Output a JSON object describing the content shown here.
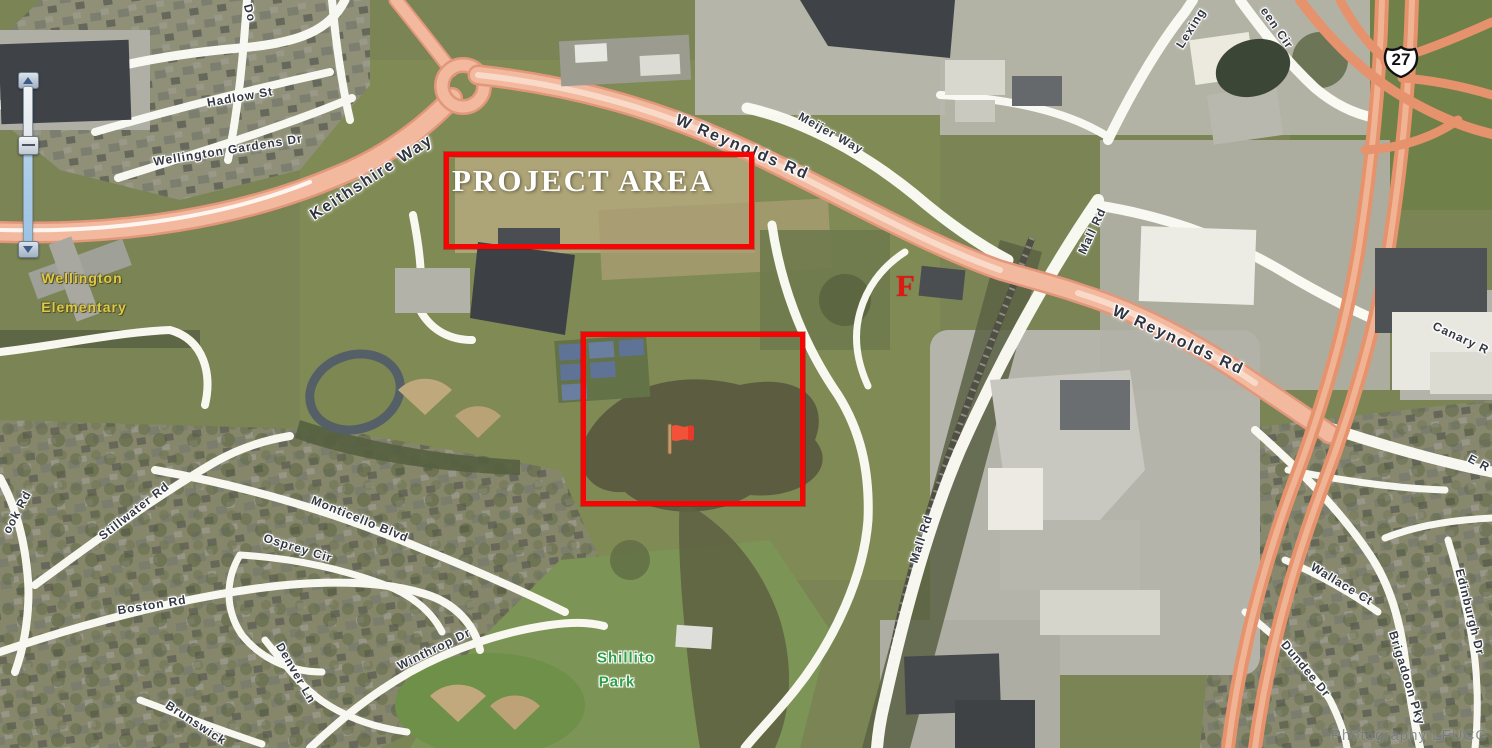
{
  "map": {
    "annotations": {
      "project_area_label": "PROJECT AREA",
      "f_marker": "F",
      "highway_shield": "27",
      "watermark": "Photography LFUCG"
    },
    "labels": [
      {
        "text": "Do",
        "x": 250,
        "y": 13,
        "rot": 75,
        "kind": "road",
        "name": "road-label-do-partial"
      },
      {
        "text": "Hadlow St",
        "x": 240,
        "y": 97,
        "rot": -10,
        "kind": "road",
        "name": "road-label-hadlow-st"
      },
      {
        "text": "Wellington Gardens Dr",
        "x": 228,
        "y": 150,
        "rot": -9,
        "kind": "road",
        "name": "road-label-wellington-gardens-dr"
      },
      {
        "text": "Keithshire Way",
        "x": 372,
        "y": 178,
        "rot": -33,
        "kind": "road-big",
        "name": "road-label-keithshire-way"
      },
      {
        "text": "W Reynolds Rd",
        "x": 742,
        "y": 148,
        "rot": 23,
        "kind": "road-big",
        "name": "road-label-w-reynolds-rd-west"
      },
      {
        "text": "Meijer Way",
        "x": 831,
        "y": 133,
        "rot": 29,
        "kind": "road",
        "name": "road-label-meijer-way"
      },
      {
        "text": "Lexing",
        "x": 1191,
        "y": 28,
        "rot": -58,
        "kind": "road",
        "name": "road-label-lexington-green-cir-1"
      },
      {
        "text": "een Cir",
        "x": 1277,
        "y": 28,
        "rot": 55,
        "kind": "road",
        "name": "road-label-lexington-green-cir-2"
      },
      {
        "text": "Mall Rd",
        "x": 1092,
        "y": 231,
        "rot": -65,
        "kind": "road",
        "name": "road-label-mall-rd-north"
      },
      {
        "text": "W Reynolds Rd",
        "x": 1178,
        "y": 341,
        "rot": 25,
        "kind": "road-big",
        "name": "road-label-w-reynolds-rd-east"
      },
      {
        "text": "Canary R",
        "x": 1461,
        "y": 338,
        "rot": 25,
        "kind": "road",
        "name": "road-label-canary-rd"
      },
      {
        "text": "E R",
        "x": 1479,
        "y": 463,
        "rot": 28,
        "kind": "road",
        "name": "road-label-e-reynolds-partial"
      },
      {
        "text": "Mall Rd",
        "x": 921,
        "y": 539,
        "rot": -72,
        "kind": "road",
        "name": "road-label-mall-rd-south"
      },
      {
        "text": "Monticello Blvd",
        "x": 360,
        "y": 519,
        "rot": 22,
        "kind": "road",
        "name": "road-label-monticello-blvd"
      },
      {
        "text": "Osprey Cir",
        "x": 298,
        "y": 548,
        "rot": 17,
        "kind": "road",
        "name": "road-label-osprey-cir"
      },
      {
        "text": "Stillwater Rd",
        "x": 134,
        "y": 511,
        "rot": -38,
        "kind": "road",
        "name": "road-label-stillwater-rd"
      },
      {
        "text": "ook Rd",
        "x": 17,
        "y": 512,
        "rot": -62,
        "kind": "road",
        "name": "road-label-ook-rd-partial"
      },
      {
        "text": "Boston Rd",
        "x": 152,
        "y": 605,
        "rot": -9,
        "kind": "road",
        "name": "road-label-boston-rd"
      },
      {
        "text": "Denver Ln",
        "x": 296,
        "y": 673,
        "rot": 60,
        "kind": "road",
        "name": "road-label-denver-ln"
      },
      {
        "text": "Winthrop Dr",
        "x": 434,
        "y": 649,
        "rot": -26,
        "kind": "road",
        "name": "road-label-winthrop-dr"
      },
      {
        "text": "Brunswick",
        "x": 196,
        "y": 723,
        "rot": 33,
        "kind": "road",
        "name": "road-label-brunswick"
      },
      {
        "text": "Wallace Ct",
        "x": 1342,
        "y": 584,
        "rot": 31,
        "kind": "road",
        "name": "road-label-wallace-ct"
      },
      {
        "text": "Brigadoon Pky",
        "x": 1407,
        "y": 678,
        "rot": 73,
        "kind": "road",
        "name": "road-label-brigadoon-pky"
      },
      {
        "text": "Edinburgh Dr",
        "x": 1470,
        "y": 612,
        "rot": 76,
        "kind": "road",
        "name": "road-label-edinburgh-dr"
      },
      {
        "text": "Dundee Dr",
        "x": 1306,
        "y": 669,
        "rot": 50,
        "kind": "road",
        "name": "road-label-dundee-dr"
      },
      {
        "text": "Wellington",
        "x": 82,
        "y": 278,
        "rot": 0,
        "kind": "place-yellow",
        "name": "place-label-wellington-1"
      },
      {
        "text": "Elementary",
        "x": 84,
        "y": 307,
        "rot": 0,
        "kind": "place-yellow",
        "name": "place-label-wellington-2"
      },
      {
        "text": "Shillito",
        "x": 626,
        "y": 658,
        "rot": 0,
        "kind": "place-green",
        "name": "place-label-shillito-1"
      },
      {
        "text": "Park",
        "x": 617,
        "y": 682,
        "rot": 0,
        "kind": "place-green",
        "name": "place-label-shillito-2"
      }
    ]
  }
}
